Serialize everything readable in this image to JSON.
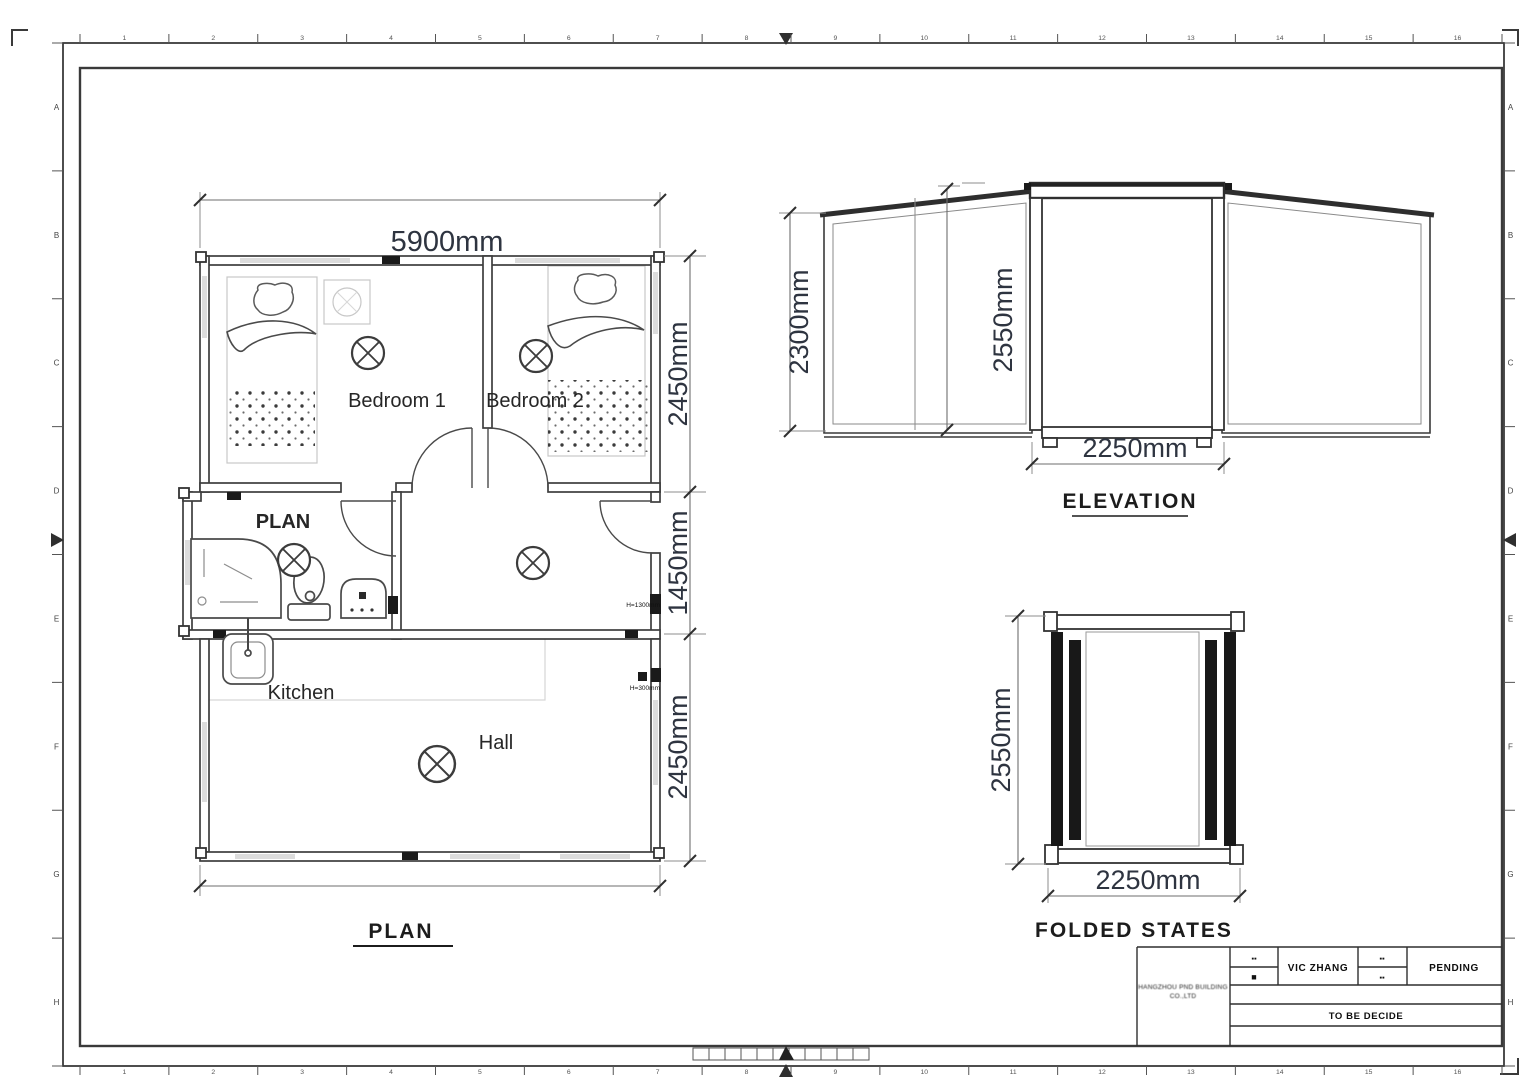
{
  "sheet": {
    "bg": "#ffffff",
    "line_color": "#3d3d3d",
    "dim_text_color": "#2e3440",
    "dark_fill": "#1a1a1a"
  },
  "frame": {
    "top_numbers": [
      "1",
      "2",
      "3",
      "4",
      "5",
      "6",
      "7",
      "8",
      "9",
      "10",
      "11",
      "12",
      "13",
      "14",
      "15",
      "16"
    ],
    "bottom_numbers": [
      "1",
      "2",
      "3",
      "4",
      "5",
      "6",
      "7",
      "8",
      "9",
      "10",
      "11",
      "12",
      "13",
      "14",
      "15",
      "16"
    ],
    "left_letters": [
      "A",
      "B",
      "C",
      "D",
      "E",
      "F",
      "G",
      "H"
    ],
    "right_letters": [
      "A",
      "B",
      "C",
      "D",
      "E",
      "F",
      "G",
      "H"
    ]
  },
  "plan": {
    "title": "PLAN",
    "rooms": {
      "bedroom1": "Bedroom 1",
      "bedroom2": "Bedroom 2",
      "bath": "PLAN",
      "kitchen": "Kitchen",
      "hall": "Hall"
    },
    "dims": {
      "width": "5900mm",
      "rows": [
        "2450mm",
        "1450mm",
        "2450mm"
      ]
    },
    "annotations": {
      "a1": "H=1300mm",
      "a2": "H=300mm"
    }
  },
  "elevation": {
    "title": "ELEVATION",
    "dims": {
      "side_height": "2300mm",
      "center_height": "2550mm",
      "center_width": "2250mm"
    }
  },
  "folded": {
    "title": "FOLDED STATES",
    "dims": {
      "height": "2550mm",
      "width": "2250mm"
    }
  },
  "title_block": {
    "company_line1": "HANGZHOU PND BUILDING",
    "company_line2": "CO.,LTD",
    "drafter": "VIC ZHANG",
    "status": "PENDING",
    "note": "TO BE DECIDE",
    "stamps": {
      "s1": "▪▪",
      "s2": "■",
      "s3": "▪▪",
      "s4": "▪▪"
    }
  }
}
